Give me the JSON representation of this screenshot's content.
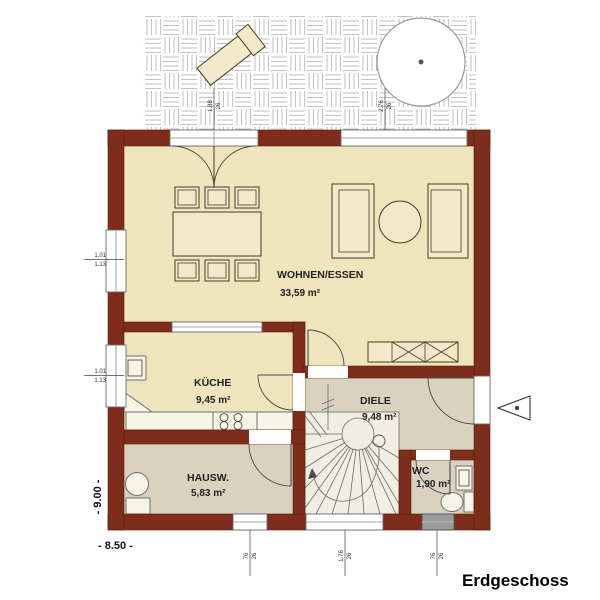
{
  "floor_title": "Erdgeschoss",
  "rooms": {
    "living": {
      "name": "WOHNEN/ESSEN",
      "area": "33,59 m²"
    },
    "kitchen": {
      "name": "KÜCHE",
      "area": "9,45 m²"
    },
    "hall": {
      "name": "DIELE",
      "area": "9,48 m²"
    },
    "utility": {
      "name": "HAUSW.",
      "area": "5,83 m²"
    },
    "wc": {
      "name": "WC",
      "area": "1,90 m²"
    }
  },
  "dimensions": {
    "overall_width": "- 8.50 -",
    "overall_height": "- 9.00 -",
    "window_living_left": {
      "l1": "1.01",
      "l2": "1.13"
    },
    "window_kitchen_left": {
      "l1": "1.01",
      "l2": "1.13"
    },
    "door_terrace_top": {
      "l1": "1.88",
      "l2": "26"
    },
    "window_living_top": {
      "l1": "2.76",
      "l2": "26"
    },
    "window_utility_bottom": {
      "l1": "76",
      "l2": "26"
    },
    "window_stair_bottom": {
      "l1": "1.76",
      "l2": "26"
    },
    "window_wc_bottom": {
      "l1": "76",
      "l2": "26"
    }
  },
  "colors": {
    "wall": "#7e2c1b",
    "floor_main": "#efe5bc",
    "floor_service": "#d8d2bf"
  }
}
